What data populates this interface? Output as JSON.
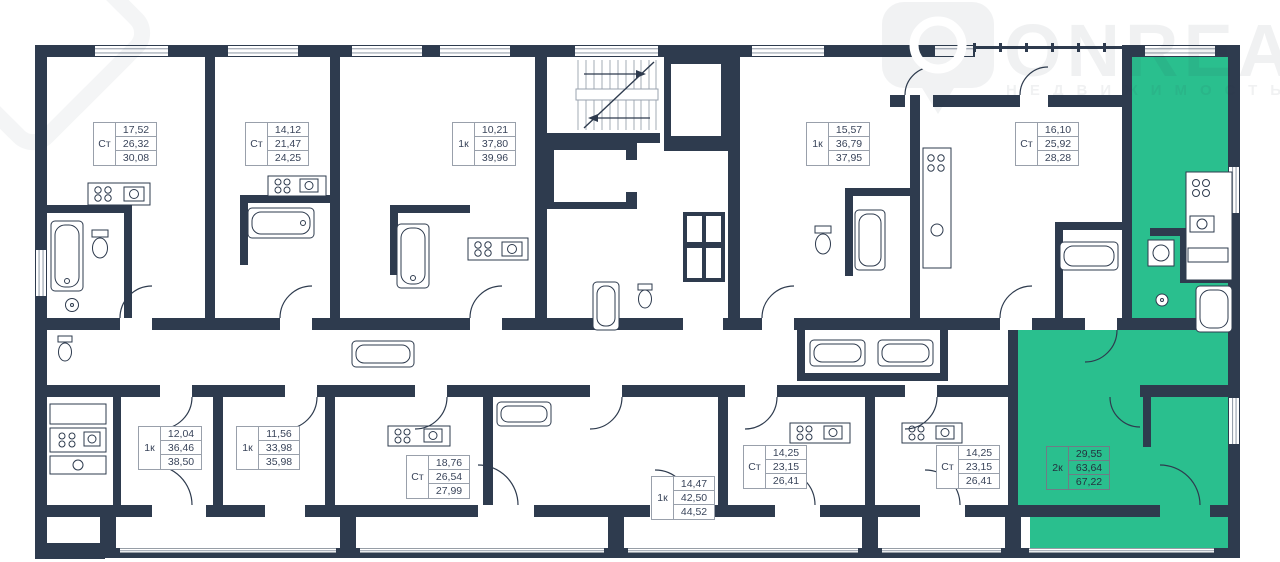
{
  "watermark": {
    "brand": "ONREALT",
    "subtitle": "НЕДВИЖИМОСТЬ",
    "pin_icon": "location-pin-icon"
  },
  "colors": {
    "wall": "#2e3b4e",
    "highlight_green": "#2abf8e",
    "label_border": "#99a0ab",
    "label_text": "#39445a",
    "window_line": "#97a0ac"
  },
  "units": [
    {
      "type": "Ст",
      "values": [
        "17,52",
        "26,32",
        "30,08"
      ],
      "highlighted": false
    },
    {
      "type": "Ст",
      "values": [
        "14,12",
        "21,47",
        "24,25"
      ],
      "highlighted": false
    },
    {
      "type": "1к",
      "values": [
        "10,21",
        "37,80",
        "39,96"
      ],
      "highlighted": false
    },
    {
      "type": "1к",
      "values": [
        "15,57",
        "36,79",
        "37,95"
      ],
      "highlighted": false
    },
    {
      "type": "Ст",
      "values": [
        "16,10",
        "25,92",
        "28,28"
      ],
      "highlighted": false
    },
    {
      "type": "1к",
      "values": [
        "12,04",
        "36,46",
        "38,50"
      ],
      "highlighted": false
    },
    {
      "type": "1к",
      "values": [
        "11,56",
        "33,98",
        "35,98"
      ],
      "highlighted": false
    },
    {
      "type": "Ст",
      "values": [
        "18,76",
        "26,54",
        "27,99"
      ],
      "highlighted": false
    },
    {
      "type": "1к",
      "values": [
        "14,47",
        "42,50",
        "44,52"
      ],
      "highlighted": false
    },
    {
      "type": "Ст",
      "values": [
        "14,25",
        "23,15",
        "26,41"
      ],
      "highlighted": false
    },
    {
      "type": "Ст",
      "values": [
        "14,25",
        "23,15",
        "26,41"
      ],
      "highlighted": false
    },
    {
      "type": "2к",
      "values": [
        "29,55",
        "63,64",
        "67,22"
      ],
      "highlighted": true
    }
  ]
}
